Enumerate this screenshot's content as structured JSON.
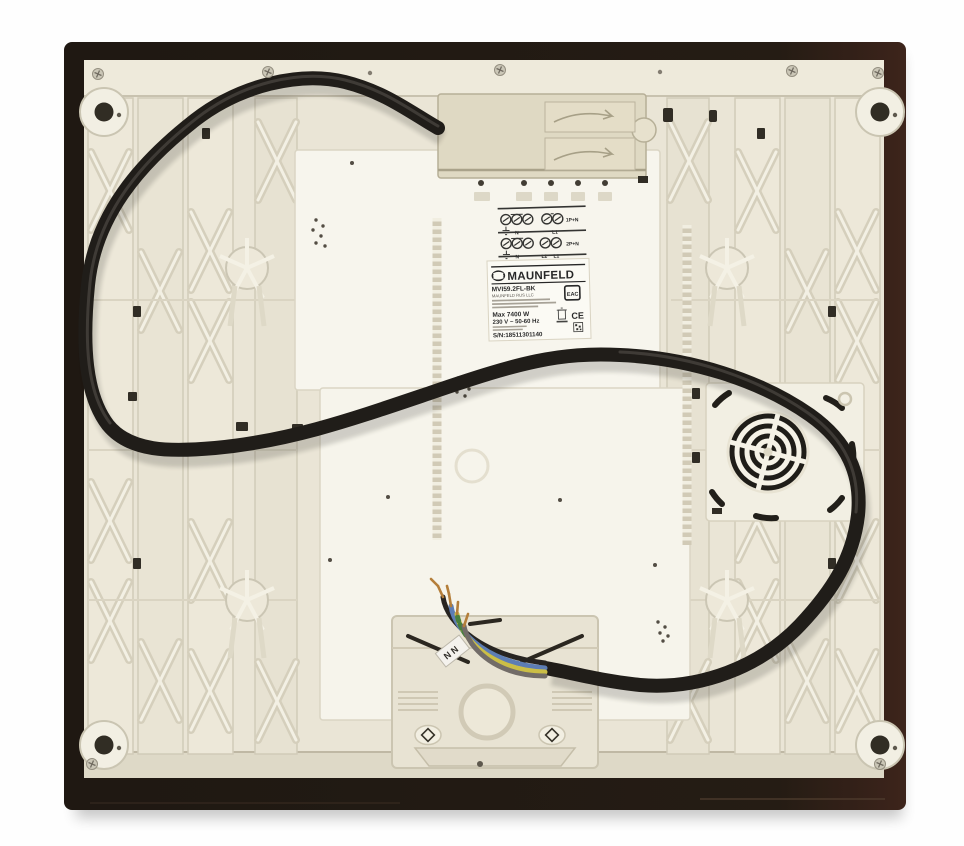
{
  "scene": {
    "description": "Underside view of a built-in induction hob with black power cable looped over cream plastic base",
    "product": "Induction hob (bottom view)"
  },
  "label": {
    "brand": "MAUNFELD",
    "model": "MVI59.2FL-BK",
    "manufacturer_line": "MAUNFELD RUS LLC",
    "power": "Max 7400 W",
    "voltage": "230 V ~ 50-60 Hz",
    "serial": "S/N:18511301140",
    "eac_mark": "EAC",
    "ce_mark": "CE"
  },
  "wiring_diagram": {
    "rows": [
      {
        "n_label": "N",
        "l_labels": [
          "L1"
        ],
        "group_label": "1P+N"
      },
      {
        "n_label": "N",
        "l_labels": [
          "L2",
          "L1"
        ],
        "group_label": "2P+N"
      }
    ]
  },
  "wire_tag": "N N",
  "colors": {
    "frame_dark": "#170f08",
    "base_cream": "#e9e4d4",
    "panel_white": "#f6f4ea",
    "cable_black": "#17130f",
    "wire_blue": "#5577b0",
    "wire_earth_yellow": "#c9bb3d",
    "copper": "#b07830"
  }
}
